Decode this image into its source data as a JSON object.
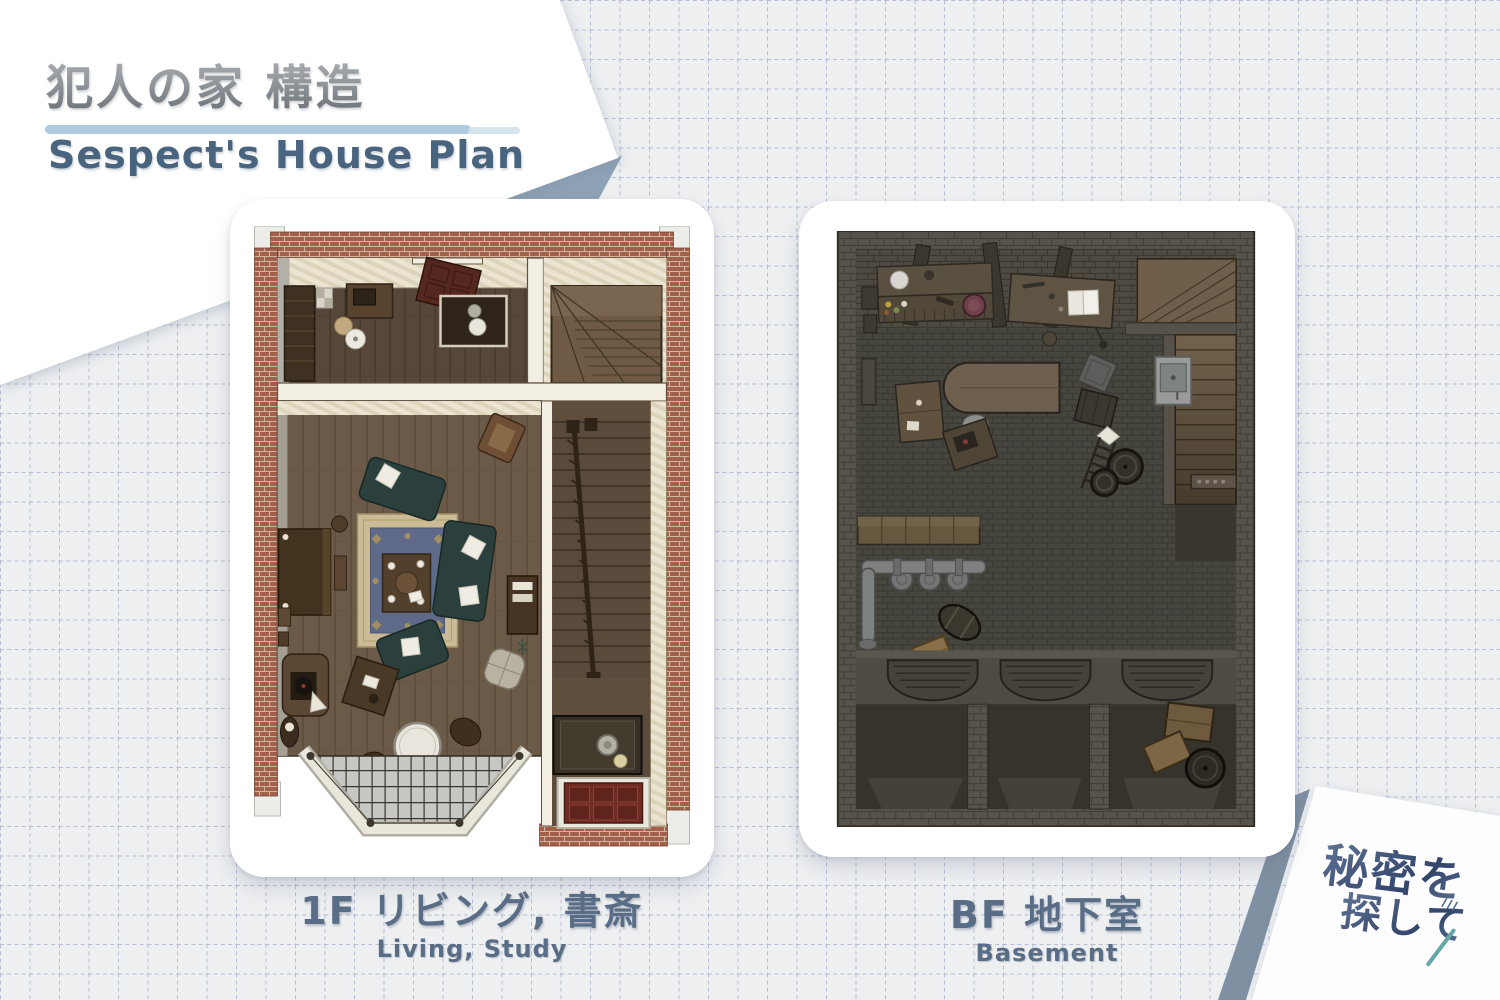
{
  "page": {
    "background_color": "#edeff1",
    "grid_color": "#b5bed6",
    "paper_shadow_color": "#8ea2b5"
  },
  "header": {
    "title_jp": "犯人の家 構造",
    "title_en": "Sespect's House Plan",
    "underline_color": "#aecbdf",
    "title_en_color": "#49647f"
  },
  "plans": {
    "first_floor": {
      "caption_jp": "1F リビング, 書斎",
      "caption_en": "Living, Study"
    },
    "basement": {
      "caption_jp": "BF 地下室",
      "caption_en": "Basement"
    }
  },
  "logo": {
    "line1": "秘密を",
    "line2": "探して",
    "color": "#45577c",
    "accent_color": "#63a7a8"
  }
}
